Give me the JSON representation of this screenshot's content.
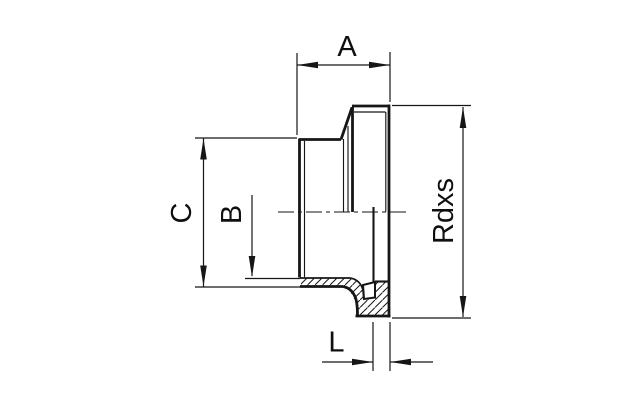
{
  "drawing": {
    "background_color": "#ffffff",
    "line_color": "#161616",
    "label_color": "#0f0f12",
    "labels": {
      "a": "A",
      "b": "B",
      "c": "C",
      "rdxs": "Rdxs",
      "l": "L"
    }
  }
}
